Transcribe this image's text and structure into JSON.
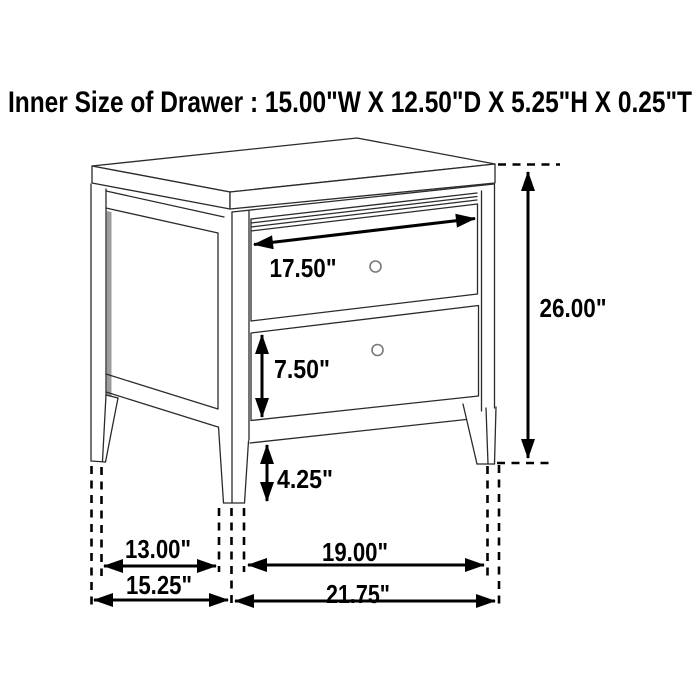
{
  "title": "Inner Size of Drawer : 15.00\"W X 12.50\"D X 5.25\"H X 0.25\"T",
  "inner_drawer_size": {
    "width": "15.00\"",
    "depth": "12.50\"",
    "height": "5.25\"",
    "thickness": "0.25\""
  },
  "diagram": {
    "type": "furniture-dimension-diagram",
    "item": "two-drawer nightstand line drawing",
    "drawer_count": 2,
    "dimensions": [
      {
        "id": "top-drawer-width",
        "label": "17.50\"",
        "value_in": 17.5,
        "orientation": "diagonal"
      },
      {
        "id": "overall-height",
        "label": "26.00\"",
        "value_in": 26.0,
        "orientation": "vertical"
      },
      {
        "id": "bottom-drawer-height",
        "label": "7.50\"",
        "value_in": 7.5,
        "orientation": "vertical"
      },
      {
        "id": "leg-height",
        "label": "4.25\"",
        "value_in": 4.25,
        "orientation": "vertical"
      },
      {
        "id": "depth-between-legs",
        "label": "13.00\"",
        "value_in": 13.0,
        "orientation": "horizontal"
      },
      {
        "id": "overall-depth",
        "label": "15.25\"",
        "value_in": 15.25,
        "orientation": "horizontal"
      },
      {
        "id": "width-between-legs",
        "label": "19.00\"",
        "value_in": 19.0,
        "orientation": "horizontal"
      },
      {
        "id": "overall-width",
        "label": "21.75\"",
        "value_in": 21.75,
        "orientation": "horizontal"
      }
    ]
  },
  "colors": {
    "background": "#ffffff",
    "line": "#000000",
    "furniture_line": "#2b2b2b",
    "text": "#000000",
    "panel_shadow": "#9c9c9c"
  }
}
